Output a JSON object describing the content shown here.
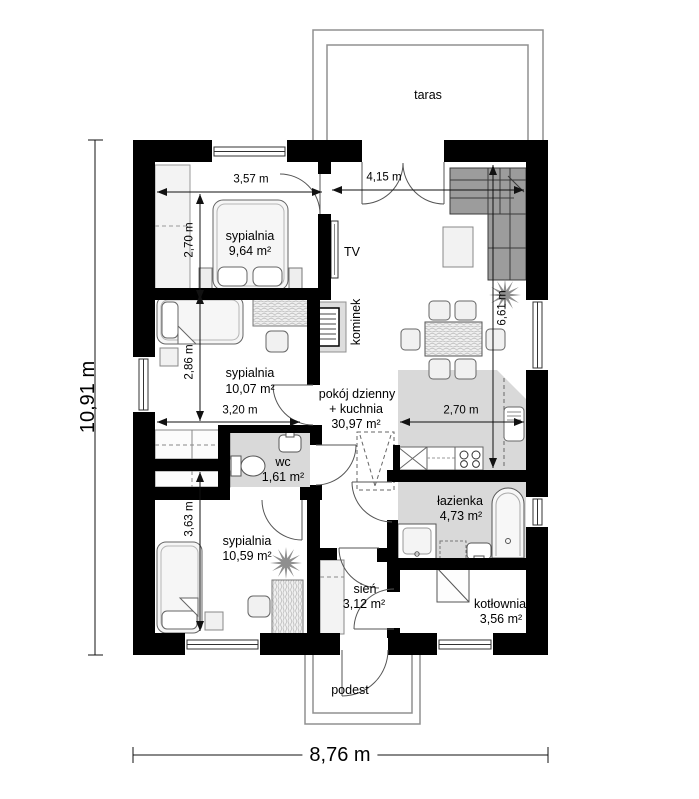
{
  "floorplan": {
    "outdoor": {
      "terrace": "taras",
      "porch": "podest"
    },
    "rooms": [
      {
        "name": "sypialnia",
        "area": "9,64 m²"
      },
      {
        "name": "sypialnia",
        "area": "10,07 m²"
      },
      {
        "name": "sypialnia",
        "area": "10,59 m²"
      },
      {
        "name": "pokój dzienny",
        "name2": "+ kuchnia",
        "area": "30,97 m²"
      },
      {
        "name": "wc",
        "area": "1,61 m²"
      },
      {
        "name": "łazienka",
        "area": "4,73 m²"
      },
      {
        "name": "sień",
        "area": "3,12 m²"
      },
      {
        "name": "kotłownia",
        "area": "3,56 m²"
      }
    ],
    "features": {
      "tv": "TV",
      "fireplace": "kominek"
    },
    "dimensions": {
      "overall_width": "8,76 m",
      "overall_height": "10,91 m",
      "bedroom1_width": "3,57 m",
      "living_top_width": "4,15 m",
      "bedroom1_depth": "2,70 m",
      "bedroom2_depth": "2,86 m",
      "bedroom2_width": "3,20 m",
      "bedroom3_depth": "3,63 m",
      "living_depth": "6,61 m",
      "kitchen_width": "2,70 m"
    },
    "colors": {
      "wall": "#000000",
      "wet_floor": "#d9d9d9",
      "sofa": "#9c9c9c"
    }
  }
}
